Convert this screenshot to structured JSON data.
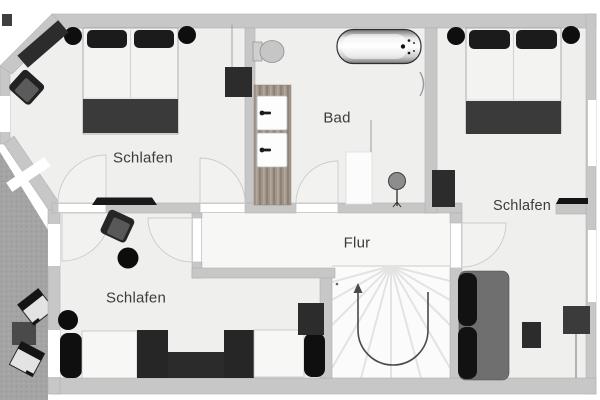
{
  "document": {
    "type": "floor-plan-upper-storey"
  },
  "rooms": [
    {
      "id": "bedroom-top-left",
      "label": "Schlafen",
      "furniture": [
        "double-bed",
        "pillow",
        "pillow",
        "round-nightstand",
        "round-nightstand",
        "sideboard",
        "armchair",
        "wardrobe",
        "tv-board"
      ]
    },
    {
      "id": "bathroom",
      "label": "Bad",
      "furniture": [
        "toilet",
        "bathtub",
        "double-vanity",
        "shower-tray",
        "floor-lamp",
        "towel-radiator"
      ]
    },
    {
      "id": "bedroom-right",
      "label": "Schlafen",
      "furniture": [
        "double-bed",
        "pillow",
        "pillow",
        "round-nightstand",
        "round-nightstand",
        "wardrobe",
        "wall-shelf",
        "sofa",
        "side-table",
        "desk"
      ]
    },
    {
      "id": "hallway",
      "label": "Flur",
      "furniture": [
        "winder-staircase"
      ]
    },
    {
      "id": "bedroom-bottom-left",
      "label": "Schlafen",
      "furniture": [
        "armchair",
        "round-side-table",
        "round-side-table",
        "daybed",
        "daybed",
        "low-table",
        "bolster-cushion",
        "bolster-cushion",
        "chest"
      ]
    }
  ],
  "outdoor": {
    "id": "terrace",
    "furniture": [
      "patio-chair",
      "patio-chair",
      "patio-table"
    ]
  },
  "stairs": {
    "direction_arrow": "up-and-around"
  },
  "colors": {
    "background": "#ffffff",
    "wall": "#c7c7c7",
    "floor": "#efefee",
    "hallway_floor": "#f7f7f6",
    "stairs_floor": "#fbfbfb",
    "terrace": "#a4a4a4",
    "furniture_dark": "#2c2c2c",
    "pillow_black": "#121212",
    "sofa_gray": "#6f6f6f",
    "blanket_gray": "#3a3a3a",
    "label_text": "#3c3c3c"
  }
}
